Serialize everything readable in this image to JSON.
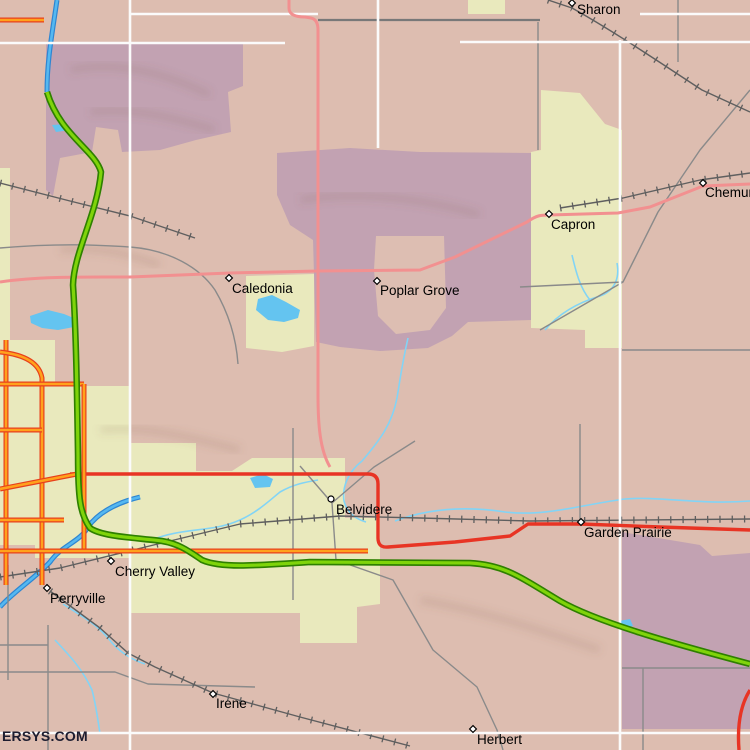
{
  "map": {
    "attribution": "ERSYS.COM",
    "palette": {
      "bg": "#ddbdb0",
      "purple": "#c2a2b2",
      "inset": "#ddbeb2",
      "yellow": "#e9e9bd",
      "white_road": "#fbfbfb",
      "gray_road": "#8a8a8a",
      "gray2_road": "#787878",
      "rail": "#5f5f5f",
      "pink_road": "#f29090",
      "red_road": "#e83424",
      "orange_core": "#ffa21c",
      "orange_casing": "#e8401c",
      "green_core": "#7fd40a",
      "green_casing": "#2e8000",
      "river_core": "#55b8f0",
      "river_casing": "#2e86d2",
      "stream": "#82d4f6",
      "lake": "#64c4f0",
      "shade": "#7d5a4a",
      "label": "#000000"
    },
    "towns": [
      {
        "name": "Sharon",
        "x": 572,
        "y": 3,
        "marker": "diamond",
        "lx": 577,
        "ly": 14
      },
      {
        "name": "Chemung",
        "x": 703,
        "y": 183,
        "marker": "diamond",
        "lx": 705,
        "ly": 197
      },
      {
        "name": "Capron",
        "x": 549,
        "y": 214,
        "marker": "diamond",
        "lx": 551,
        "ly": 229
      },
      {
        "name": "Caledonia",
        "x": 229,
        "y": 278,
        "marker": "diamond",
        "lx": 232,
        "ly": 293
      },
      {
        "name": "Poplar Grove",
        "x": 377,
        "y": 281,
        "marker": "diamond",
        "lx": 380,
        "ly": 295
      },
      {
        "name": "Belvidere",
        "x": 331,
        "y": 499,
        "marker": "circle",
        "lx": 336,
        "ly": 514
      },
      {
        "name": "Garden Prairie",
        "x": 581,
        "y": 522,
        "marker": "diamond",
        "lx": 584,
        "ly": 537
      },
      {
        "name": "Cherry Valley",
        "x": 111,
        "y": 561,
        "marker": "diamond",
        "lx": 115,
        "ly": 576
      },
      {
        "name": "Perryville",
        "x": 47,
        "y": 588,
        "marker": "diamond",
        "lx": 50,
        "ly": 603
      },
      {
        "name": "Irene",
        "x": 213,
        "y": 694,
        "marker": "diamond",
        "lx": 216,
        "ly": 708
      },
      {
        "name": "Herbert",
        "x": 473,
        "y": 729,
        "marker": "diamond",
        "lx": 477,
        "ly": 744
      }
    ],
    "regions": [
      {
        "kind": "purple",
        "points": [
          [
            46,
            44
          ],
          [
            243,
            44
          ],
          [
            243,
            86
          ],
          [
            228,
            92
          ],
          [
            231,
            132
          ],
          [
            196,
            140
          ],
          [
            160,
            150
          ],
          [
            122,
            152
          ],
          [
            118,
            130
          ],
          [
            96,
            127
          ],
          [
            92,
            152
          ],
          [
            60,
            158
          ],
          [
            53,
            196
          ],
          [
            46,
            190
          ]
        ]
      },
      {
        "kind": "purple",
        "points": [
          [
            277,
            153
          ],
          [
            350,
            148
          ],
          [
            420,
            152
          ],
          [
            531,
            153
          ],
          [
            534,
            240
          ],
          [
            531,
            320
          ],
          [
            468,
            322
          ],
          [
            452,
            336
          ],
          [
            428,
            348
          ],
          [
            380,
            351
          ],
          [
            340,
            347
          ],
          [
            316,
            342
          ],
          [
            313,
            240
          ],
          [
            290,
            225
          ],
          [
            277,
            195
          ]
        ]
      },
      {
        "kind": "inset",
        "points": [
          [
            376,
            236
          ],
          [
            444,
            236
          ],
          [
            446,
            308
          ],
          [
            430,
            330
          ],
          [
            396,
            334
          ],
          [
            378,
            316
          ],
          [
            374,
            270
          ]
        ]
      },
      {
        "kind": "purple",
        "points": [
          [
            622,
            532
          ],
          [
            700,
            545
          ],
          [
            712,
            556
          ],
          [
            750,
            553
          ],
          [
            750,
            729
          ],
          [
            622,
            729
          ]
        ]
      },
      {
        "kind": "yellow",
        "points": [
          [
            541,
            90
          ],
          [
            580,
            93
          ],
          [
            605,
            124
          ],
          [
            622,
            130
          ],
          [
            622,
            348
          ],
          [
            585,
            348
          ],
          [
            585,
            330
          ],
          [
            531,
            328
          ],
          [
            531,
            152
          ],
          [
            541,
            150
          ]
        ]
      },
      {
        "kind": "yellow",
        "points": [
          [
            246,
            276
          ],
          [
            314,
            274
          ],
          [
            314,
            346
          ],
          [
            282,
            352
          ],
          [
            246,
            348
          ]
        ]
      },
      {
        "kind": "yellow",
        "points": [
          [
            0,
            168
          ],
          [
            10,
            168
          ],
          [
            10,
            340
          ],
          [
            55,
            340
          ],
          [
            55,
            386
          ],
          [
            130,
            386
          ],
          [
            130,
            443
          ],
          [
            196,
            443
          ],
          [
            196,
            471
          ],
          [
            232,
            471
          ],
          [
            232,
            558
          ],
          [
            35,
            558
          ],
          [
            35,
            545
          ],
          [
            0,
            545
          ]
        ]
      },
      {
        "kind": "yellow",
        "points": [
          [
            232,
            471
          ],
          [
            252,
            458
          ],
          [
            345,
            458
          ],
          [
            345,
            518
          ],
          [
            380,
            518
          ],
          [
            380,
            604
          ],
          [
            357,
            607
          ],
          [
            357,
            643
          ],
          [
            300,
            643
          ],
          [
            300,
            613
          ],
          [
            130,
            613
          ],
          [
            130,
            558
          ],
          [
            232,
            558
          ]
        ]
      },
      {
        "kind": "yellow",
        "points": [
          [
            468,
            0
          ],
          [
            505,
            0
          ],
          [
            505,
            14
          ],
          [
            468,
            14
          ]
        ]
      }
    ],
    "lakes": [
      {
        "points": [
          [
            258,
            299
          ],
          [
            272,
            295
          ],
          [
            286,
            302
          ],
          [
            300,
            310
          ],
          [
            298,
            318
          ],
          [
            284,
            322
          ],
          [
            268,
            320
          ],
          [
            256,
            310
          ]
        ]
      },
      {
        "points": [
          [
            30,
            316
          ],
          [
            48,
            310
          ],
          [
            64,
            314
          ],
          [
            76,
            319
          ],
          [
            74,
            327
          ],
          [
            58,
            330
          ],
          [
            42,
            328
          ],
          [
            31,
            323
          ]
        ]
      },
      {
        "points": [
          [
            250,
            478
          ],
          [
            263,
            474
          ],
          [
            273,
            479
          ],
          [
            270,
            487
          ],
          [
            255,
            488
          ]
        ]
      },
      {
        "points": [
          [
            52,
            125
          ],
          [
            66,
            124
          ],
          [
            70,
            130
          ],
          [
            56,
            132
          ]
        ]
      },
      {
        "points": [
          [
            619,
            621
          ],
          [
            630,
            619
          ],
          [
            633,
            626
          ],
          [
            621,
            628
          ]
        ]
      }
    ],
    "roads": [
      {
        "kind": "shade",
        "d": "M70,70 C120,60 170,75 210,95"
      },
      {
        "kind": "shade",
        "d": "M90,112 C140,107 180,120 215,130"
      },
      {
        "kind": "shade",
        "d": "M300,200 C360,190 430,200 480,215"
      },
      {
        "kind": "shade",
        "d": "M60,250 C100,245 130,255 160,265"
      },
      {
        "kind": "shade",
        "d": "M420,600 C480,610 540,630 600,650"
      },
      {
        "kind": "shade",
        "d": "M100,430 C150,425 200,440 240,450"
      },
      {
        "kind": "stream",
        "d": "M408,338 C402,364 400,380 397,398 C392,424 380,440 362,461 C348,472 342,487 344,501 C347,513 356,519 366,522"
      },
      {
        "kind": "stream",
        "d": "M395,521 C430,508 466,506 505,512 C545,517 585,504 625,499 C660,496 700,505 750,501"
      },
      {
        "kind": "stream",
        "d": "M545,330 C560,312 580,302 600,296 C614,291 620,279 617,263"
      },
      {
        "kind": "stream",
        "d": "M55,640 C68,654 82,668 92,690 C96,705 98,720 100,734"
      },
      {
        "kind": "stream",
        "d": "M152,540 C180,528 210,532 235,522 C256,514 270,500 280,492 C294,484 306,482 318,480"
      },
      {
        "kind": "stream",
        "d": "M63,604 C80,615 95,623 108,638 C117,650 130,659 145,664"
      },
      {
        "kind": "stream",
        "d": "M572,255 C576,272 580,288 590,300"
      },
      {
        "kind": "river",
        "d": "M57,0 C52,35 47,60 47,92"
      },
      {
        "kind": "river",
        "d": "M140,497 C115,503 97,514 88,527 C80,542 62,545 50,562 C35,578 12,593 0,607"
      },
      {
        "kind": "gray",
        "d": "M0,248 C70,242 110,246 130,247 C170,250 200,268 215,290 C228,312 236,336 238,364"
      },
      {
        "kind": "gray",
        "d": "M538,22 V150"
      },
      {
        "kind": "gray",
        "d": "M678,0 V62"
      },
      {
        "kind": "gray",
        "d": "M750,90 L700,150 L658,212 L623,282 L540,330"
      },
      {
        "kind": "gray",
        "d": "M623,282 L520,287"
      },
      {
        "kind": "gray",
        "d": "M580,424 V521"
      },
      {
        "kind": "gray",
        "d": "M293,428 V600"
      },
      {
        "kind": "gray",
        "d": "M300,466 L332,503 L336,560"
      },
      {
        "kind": "gray",
        "d": "M332,503 L374,467 L415,441"
      },
      {
        "kind": "gray",
        "d": "M336,560 L393,580 L433,650 L477,687 L497,730 L503,750"
      },
      {
        "kind": "gray",
        "d": "M622,668 H750"
      },
      {
        "kind": "gray",
        "d": "M643,668 V750"
      },
      {
        "kind": "gray",
        "d": "M0,672 L115,672 L148,684 L255,687"
      },
      {
        "kind": "gray",
        "d": "M8,565 V680"
      },
      {
        "kind": "gray",
        "d": "M48,625 V750"
      },
      {
        "kind": "gray",
        "d": "M0,645 H48"
      },
      {
        "kind": "gray",
        "d": "M622,350 H750"
      },
      {
        "kind": "gray2",
        "d": "M318,20 H540"
      },
      {
        "kind": "rail",
        "d": "M548,0 L572,8 C615,32 662,64 702,90 L750,112"
      },
      {
        "kind": "rail",
        "d": "M560,208 L623,198 L700,180 L750,173"
      },
      {
        "kind": "rail",
        "d": "M0,577 L60,568 L133,550 L240,524 L340,516 L420,518 L530,521 L750,519"
      },
      {
        "kind": "rail",
        "d": "M50,591 L100,628 L128,653 L155,667 L213,693 L300,717 L410,746"
      },
      {
        "kind": "rail",
        "d": "M0,183 L70,201 L130,216 L195,238"
      },
      {
        "kind": "white",
        "d": "M130,0 V750"
      },
      {
        "kind": "white",
        "d": "M620,40 V750"
      },
      {
        "kind": "white",
        "d": "M0,43 H285"
      },
      {
        "kind": "white",
        "d": "M130,14 H318"
      },
      {
        "kind": "white",
        "d": "M460,42 H750"
      },
      {
        "kind": "white",
        "d": "M640,14 H750"
      },
      {
        "kind": "white",
        "d": "M0,733 H750"
      },
      {
        "kind": "white",
        "d": "M378,0 V148"
      },
      {
        "kind": "pink",
        "d": "M289,0 V8 C289,15 296,17 305,17 L311,18 C316,19 318,23 318,30 V395 C318,425 320,450 330,467"
      },
      {
        "kind": "pink",
        "d": "M0,282 C40,276 90,277 130,277 L230,273 L318,271 L420,270 L455,257 L527,222 C537,215 541,215 549,215 L618,213 L650,207 L703,186 L750,184"
      },
      {
        "kind": "red",
        "d": "M70,474 H368 Q378,474 378,484 V538 Q378,548 388,547 L455,542 L510,536 L528,524 L581,524 L660,527 L750,530"
      },
      {
        "kind": "red",
        "d": "M750,690 Q736,712 739,750"
      },
      {
        "kind": "orange",
        "d": "M0,20 H44"
      },
      {
        "kind": "orange",
        "d": "M6,340 V585"
      },
      {
        "kind": "orange",
        "d": "M0,352 Q38,356 42,378 V585"
      },
      {
        "kind": "orange",
        "d": "M0,384 H84"
      },
      {
        "kind": "orange",
        "d": "M0,430 H42"
      },
      {
        "kind": "orange",
        "d": "M0,489 L77,474"
      },
      {
        "kind": "orange",
        "d": "M0,520 H64"
      },
      {
        "kind": "orange",
        "d": "M84,384 V552"
      },
      {
        "kind": "orange",
        "d": "M0,551 H368"
      },
      {
        "kind": "green",
        "d": "M47,92 C60,135 95,150 101,172 C97,215 74,252 73,285 C76,330 77,390 78,455 C78,498 80,514 90,528 C102,537 140,538 162,541 C180,544 190,552 202,560 C220,568 250,566 310,562 L470,563 C505,565 520,577 560,601 C600,624 690,648 750,664"
      }
    ]
  }
}
